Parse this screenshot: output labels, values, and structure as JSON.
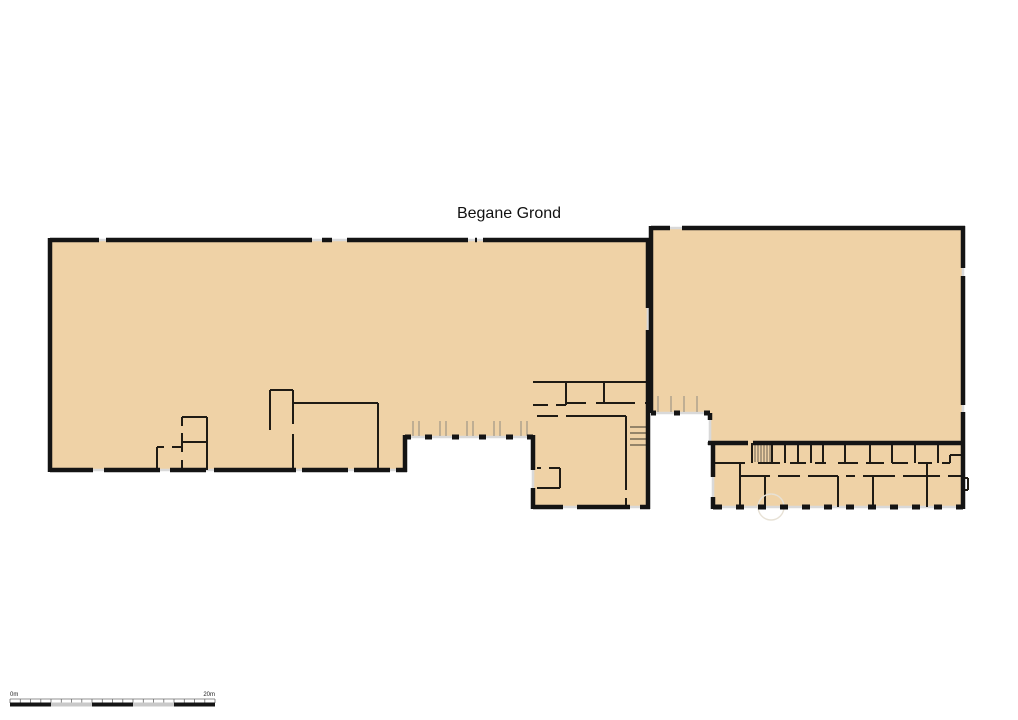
{
  "title": "Begane Grond",
  "colors": {
    "floor_fill": "#efd2a6",
    "wall": "#141414",
    "window_sill": "#d9d9d9",
    "background": "#ffffff",
    "scale_alternate": "#c9c9c9"
  },
  "scale_bar": {
    "start_label": "0m",
    "end_label": "20m",
    "total_meters": 20,
    "axis_path": "M10,699 H215",
    "ticks_path": "M10,699 V703 M20.3,699 V703 M30.5,699 V703 M40.8,699 V703 M51,699 V703 M61.3,699 V703 M71.5,699 V703 M81.8,699 V703 M92,699 V703 M102.3,699 V703 M112.5,699 V703 M122.8,699 V703 M133,699 V703 M143.3,699 V703 M153.5,699 V703 M163.8,699 V703 M174,699 V703 M184.3,699 V703 M194.5,699 V703 M204.8,699 V703 M215,699 V703",
    "segments_dark_path": "M10,704.5 H51 M92,704.5 H133 M174,704.5 H215",
    "segments_light_path": "M51,704.5 H92 M133,704.5 H174"
  },
  "floorplan": {
    "fill_left": "M50,240 H648 V507 H533 V437 H405 V470 H50 Z",
    "fill_right": "M651,228 H963 V507 H713 V443 H710 V413 H651 Z",
    "thick_left": "M50,240 H99 M106,240 H312 M322,240 H332 M347,240 H468 M475,240 H477 M483,240 H650 M50,238 V472 M50,470 H93 M104,470 H160 M170,470 H206 M214,470 H296 M302,470 H348 M354,470 H390 M396,470 H407 M405,472 V435 M648,238 V308 M648,330 V509 M533,507 H563 M577,507 H630 M640,507 H650 M533,435 V470 M533,488 V509",
    "thick_right": "M651,228 H670 M682,228 H965 M651,226 V413 M963,226 V268 M963,276 V405 M963,412 V509 M710,413 V420 M710,442 V445 M708,443 H748 M753,443 H965 M713,443 V477 M713,497 V509",
    "window_posts": "M405,437 H411 M425,437 H432 M452,437 H459 M479,437 H486 M506,437 H513 M527,437 H533 M651,413 H656 M674,413 H680 M704,413 H710",
    "bottom_dashes": "M713,507 H722 M736,507 H744 M758,507 H766 M780,507 H788 M802,507 H810 M824,507 H832 M846,507 H854 M868,507 H876 M890,507 H898 M912,507 H920 M934,507 H942 M956,507 H963",
    "sills": "M405,437 H533 M533,470 V488 M651,413 H710 M710,420 V442 M713,477 V497 M713,507 H963 M963,268 V276 M963,405 V412 M99,240 H106 M312,240 H347 M468,240 H483 M670,228 H682 M93,470 H104 M160,470 H170 M206,470 H214 M296,470 H302 M348,470 H354 M390,470 H396 M648,308 V330 M563,507 H577 M630,507 H640",
    "mullions": "M413,421 V436 M419,421 V436 M440,421 V436 M446,421 V436 M467,421 V436 M473,421 V436 M494,421 V436 M500,421 V436 M521,421 V436 M527,421 V436 M658,396 V412 M671,396 V412 M684,396 V412 M697,396 V412",
    "interior_left": "M182,417 H207 M207,417 V470 M182,417 V426 M182,433 V452 M182,460 V470 M182,442 H207 M157,447 H164 M172,447 H182 M157,447 V470 M270,390 V430 M270,390 H293 M293,390 V403 M293,403 H378 M378,403 V470 M293,403 V424 M293,434 V470",
    "interior_middle": "M533,382 H648 M566,382 V405 M604,382 V403 M533,405 H548 M556,405 H566 M566,403 H586 M596,403 H604 M604,403 H635 M645,403 H648 M537,416 H558 M566,416 H626 M626,416 V490 M626,498 V507 M537,468 H541 M549,468 H560 M560,468 V488 M537,488 H560",
    "interior_wing": "M752,443 V463 M772,443 V463 M785,443 V463 M798,443 V463 M811,443 V463 M823,443 V463 M845,443 V463 M870,443 V463 M892,443 V463 M915,443 V463 M938,443 V463 M713,463 H745 M758,463 H780 M790,463 H806 M815,463 H826 M838,463 H858 M866,463 H884 M892,463 H908 M918,463 H932 M942,463 H950 M950,455 V463 M950,455 H963 M740,463 V507 M765,476 V507 M838,476 V507 M873,476 V507 M927,463 V507 M740,476 H770 M778,476 H800 M808,476 H838 M846,476 H855 M863,476 H895 M903,476 H940 M948,476 H963 M963,478 H968 M968,478 V490 M963,490 H968",
    "stair_hatch": "M755,444 V462 M758,444 V462 M761,444 V462 M764,444 V462 M767,444 V462 M770,444 V462",
    "stair_treads": "M630,427 H648 M630,433 H648 M630,439 H648 M630,445 H648",
    "door_arc": "M771,494 a13,13 0 1 0 0.1,0"
  }
}
